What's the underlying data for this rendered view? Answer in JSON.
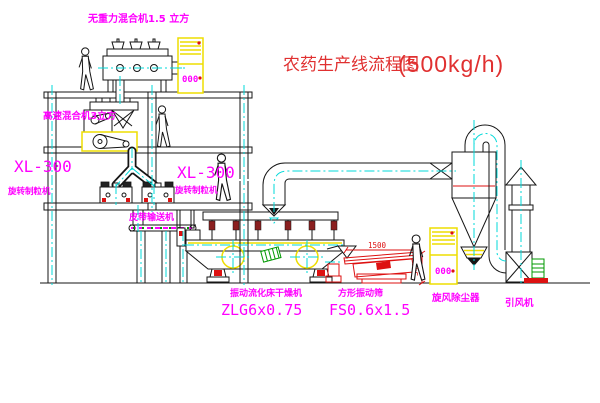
{
  "title": {
    "name": "农药生产线流程图",
    "capacity": "(500kg/h)"
  },
  "labels": {
    "gravity_mixer": "无重力混合机1.5 立方",
    "speed_mixer": "高速混合机3立方",
    "xl300_left": "XL-300",
    "granulator_left": "旋转制粒机",
    "xl300_mid": "XL-300",
    "granulator_mid": "旋转制粒机",
    "belt_conveyor": "皮带输送机",
    "dryer_name": "振动流化床干燥机",
    "dryer_model": "ZLG6x0.75",
    "screen_name": "方形振动筛",
    "screen_model": "FS0.6x1.5",
    "cyclone": "旋风除尘器",
    "fan": "引风机"
  },
  "dimensions": {
    "screen_length": "1500",
    "screen_height": "340"
  },
  "cabinet_display": "000",
  "colors": {
    "line": "#151515",
    "centerline": "#00d9d9",
    "highlight": "#eedd00",
    "label": "#ff00ff",
    "title": "#e03030",
    "accent_red": "#dd1111",
    "accent_green": "#009900"
  }
}
